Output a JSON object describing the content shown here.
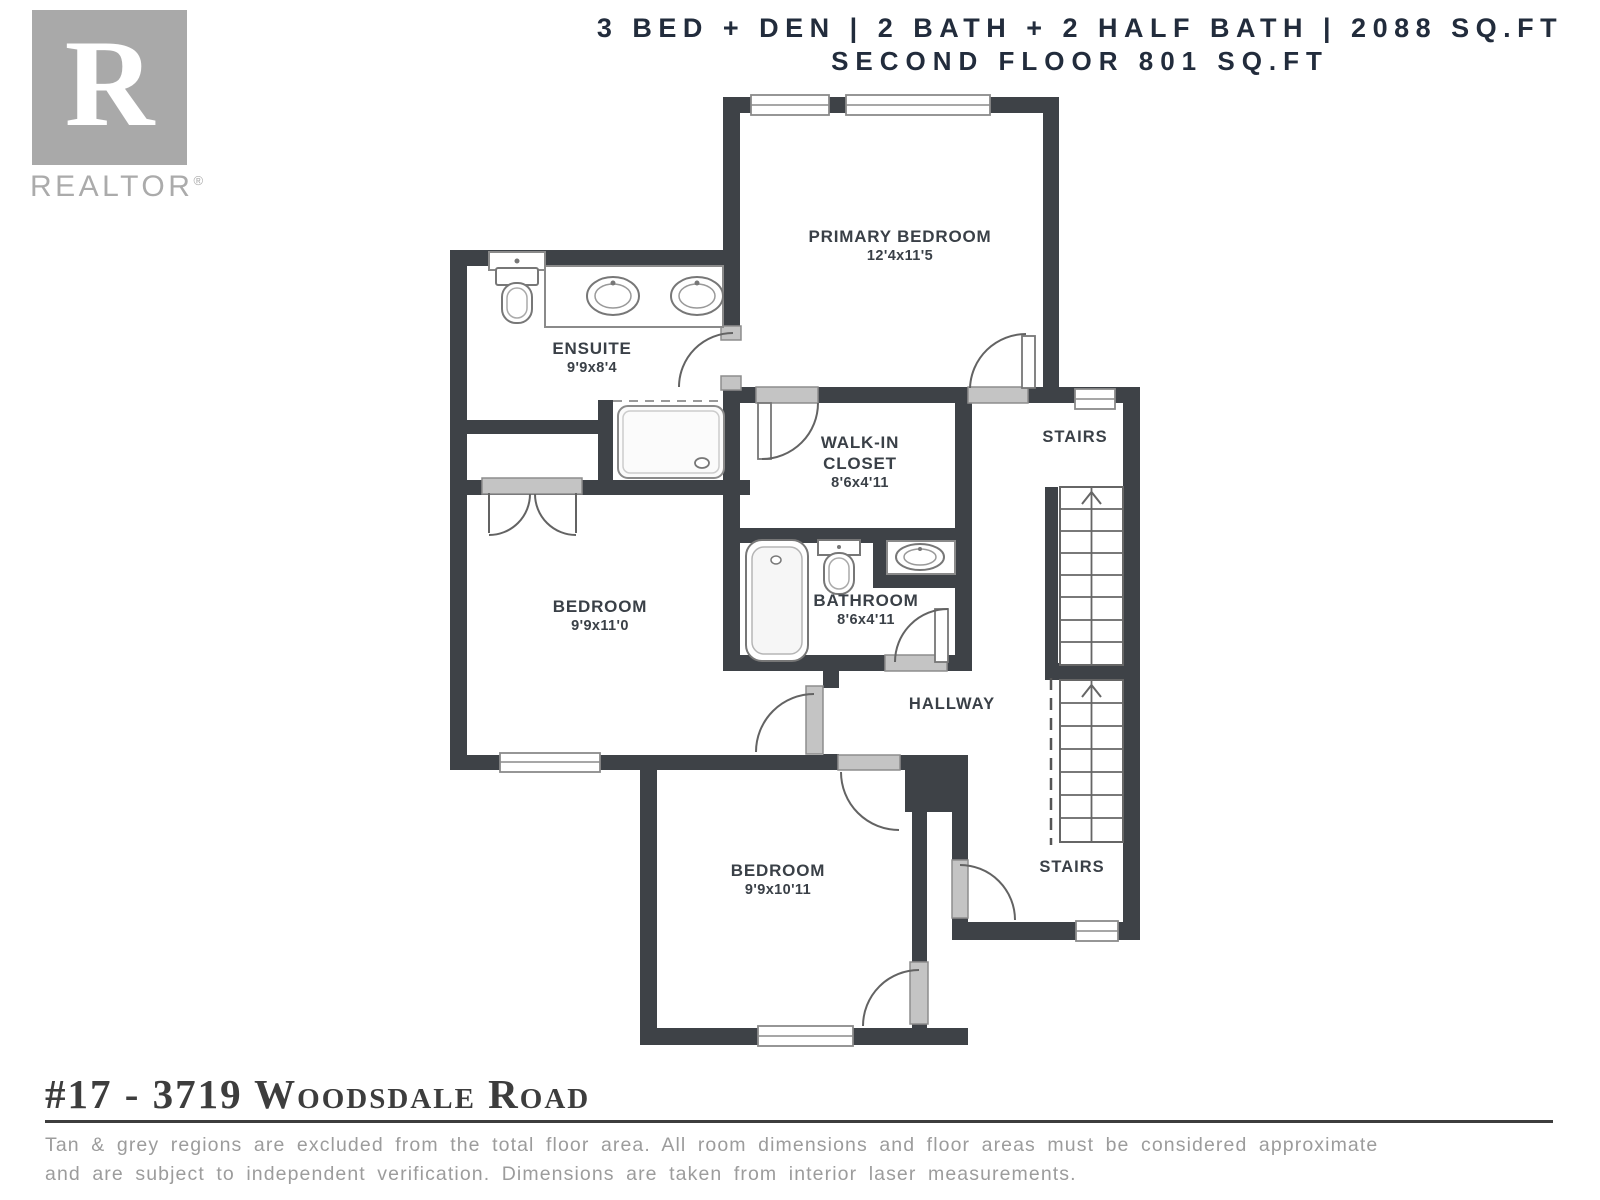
{
  "header": {
    "line1": "3 BED + DEN | 2 BATH + 2 HALF BATH | 2088 SQ.FT",
    "line2": "SECOND FLOOR 801 SQ.FT"
  },
  "logo": {
    "letter": "R",
    "name": "REALTOR",
    "registered": "®"
  },
  "plan": {
    "rooms": {
      "primary_bedroom": {
        "name": "PRIMARY BEDROOM",
        "dims": "12'4x11'5"
      },
      "ensuite": {
        "name": "ENSUITE",
        "dims": "9'9x8'4"
      },
      "walk_in_closet": {
        "name": "WALK-IN CLOSET",
        "dims": "8'6x4'11"
      },
      "bedroom_mid": {
        "name": "BEDROOM",
        "dims": "9'9x11'0"
      },
      "bathroom": {
        "name": "BATHROOM",
        "dims": "8'6x4'11"
      },
      "bedroom_lower": {
        "name": "BEDROOM",
        "dims": "9'9x10'11"
      },
      "stairs_upper": {
        "name": "STAIRS"
      },
      "stairs_lower": {
        "name": "STAIRS"
      },
      "hallway": {
        "name": "HALLWAY"
      }
    },
    "fixtures": [
      "toilet",
      "double-vanity-sinks",
      "shower",
      "bathtub",
      "toilet",
      "sink",
      "staircase-up",
      "staircase-up"
    ]
  },
  "footer": {
    "title": "#17 - 3719 Woodsdale Road",
    "disclaimer_line1": "Tan & grey regions are excluded from the total floor area. All room dimensions and floor areas must be considered approximate",
    "disclaimer_line2": "and are subject to independent verification. Dimensions are taken from interior laser measurements."
  },
  "colors": {
    "wall": "#3e4247",
    "door_sill": "#c4c4c4",
    "fixture_line": "#777777",
    "header_text": "#222c3c",
    "label_text": "#3a4047",
    "disclaimer_text": "#9c9c9c",
    "logo_grey": "#a9a9a9"
  }
}
